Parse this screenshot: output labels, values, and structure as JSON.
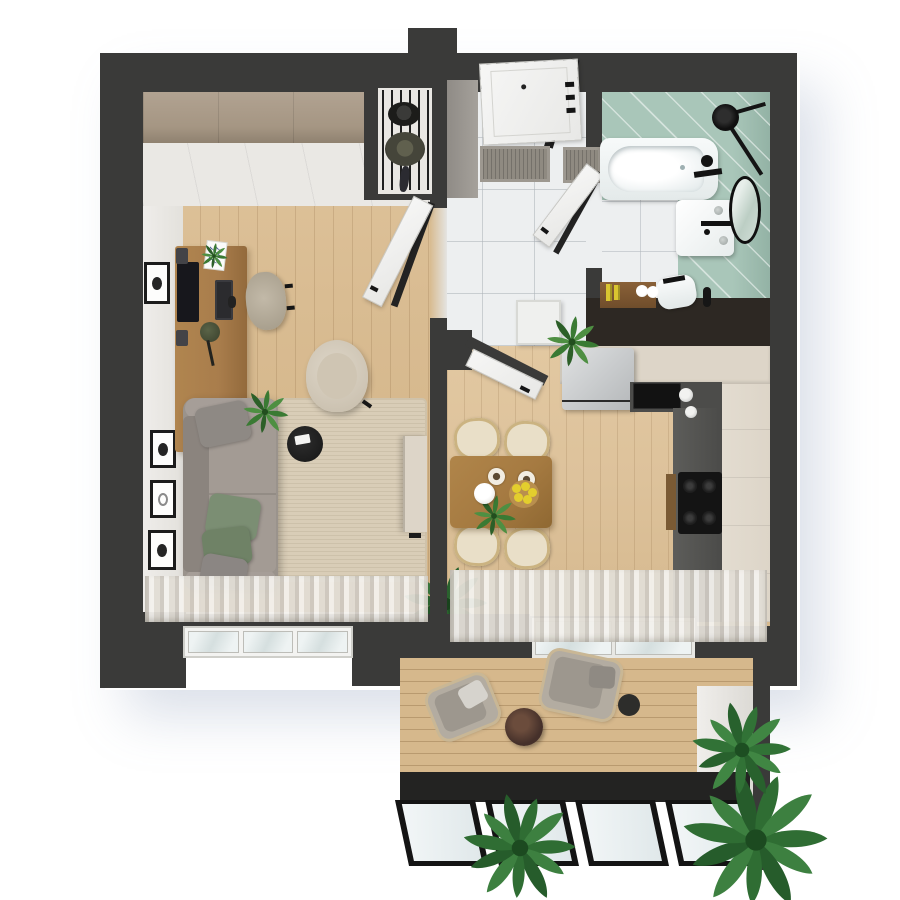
{
  "title": "Apartment floor plan - 3D top-down render",
  "scene": {
    "view": "top-down 3d architectural render",
    "background": "#ffffff",
    "rooms": [
      {
        "name": "living-room",
        "floor": "light oak planks",
        "items": [
          "wardrobe",
          "desk",
          "monitor",
          "keyboard",
          "mouse",
          "speakers (2)",
          "desk lamp",
          "notepad",
          "office chair",
          "wall frames (4)",
          "gray sofa",
          "green and gray pillows (4)",
          "beige area rug",
          "armchair",
          "round black coffee table",
          "remote",
          "tv panel",
          "potted plants (2)",
          "sheer curtains",
          "triple window"
        ]
      },
      {
        "name": "hallway",
        "floor": "white marble tile",
        "items": [
          "entrance door",
          "black door frame",
          "doormats (2)",
          "coat niche with rack",
          "hats (2)",
          "umbrella",
          "door to living room",
          "door to bathroom",
          "door to kitchen",
          "potted plant in white planter"
        ]
      },
      {
        "name": "bathroom",
        "floor": "teal tile walls with marble floor",
        "items": [
          "bathtub",
          "black rain shower set",
          "black bath faucet",
          "washbasin cabinet",
          "black basin faucet",
          "round black-rim mirror",
          "toilet",
          "toilet brush",
          "wooden shelf",
          "cosmetic bottles (2)",
          "towel rolls (2)"
        ]
      },
      {
        "name": "kitchen-dining",
        "floor": "light oak planks",
        "items": [
          "fridge",
          "cream tall cabinets",
          "dark counter",
          "built-in black sink",
          "gas hob (4 burners)",
          "cutting board",
          "mugs (2)",
          "dining table",
          "dining chairs (4)",
          "coffee cups (2)",
          "white teapot",
          "lemon bowl",
          "table plant",
          "sheer curtains"
        ]
      },
      {
        "name": "balcony",
        "floor": "wood decking",
        "items": [
          "sliding glass door",
          "rattan lounge chairs (2)",
          "cushions and pillows",
          "round side table",
          "planter pot",
          "palm plants (3)",
          "black folding glass wall (4 panels)"
        ]
      }
    ]
  },
  "colors": {
    "wall": "#3a3a39",
    "wall-brown": "#2d2823",
    "wood-living": "#d9bc92",
    "wood-kitchen": "#ddc29b",
    "deck": "#d6b88c",
    "marble": "#edeff0",
    "teal": "#a9c6b9",
    "white-wall": "#eae8e4",
    "wardrobe": "#a59683",
    "sofa": "#9a938c",
    "pillow-green": "#7b8e73",
    "rug": "#d9cdb7",
    "desk": "#a97d4c",
    "table": "#a57a41",
    "chair": "#e9dfc8",
    "cream": "#ddd5c8",
    "counter": "#515150",
    "black": "#161616",
    "fridge": "#c9cccd",
    "glass": "#e2eaea",
    "curtain-a": "#cfcac2",
    "curtain-b": "#f4f2ee",
    "plant": "#2f6d33",
    "plant-dark": "#1f5426",
    "white": "#f6f6f5"
  }
}
